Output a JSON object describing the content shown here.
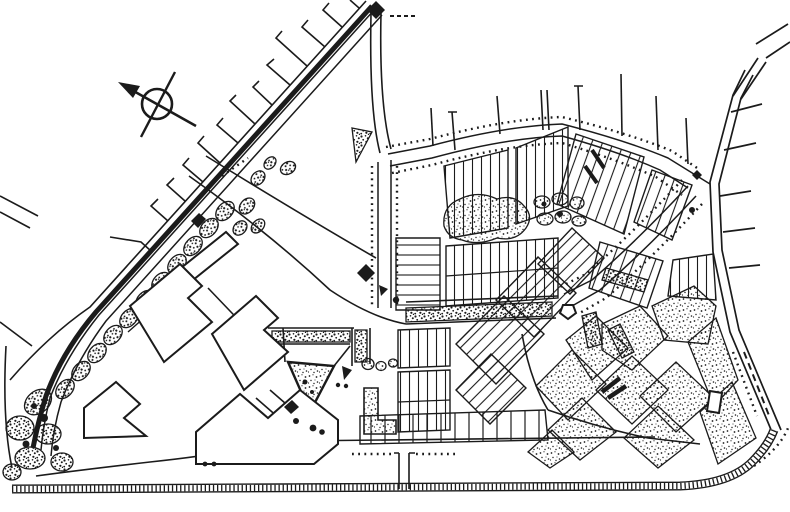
{
  "map": {
    "kind": "scanned urban master plan site drawing",
    "palette": {
      "ink": "#1b1b1b",
      "paper": "#ffffff"
    },
    "north_arrow": {
      "icon": "compass-north-arrow",
      "direction": "points to upper-left (north-west)"
    },
    "features": [
      {
        "id": "north-arrow",
        "label": "compass symbol: circle crossed by two lines, arrowhead to north-west"
      },
      {
        "id": "railway-boulevard",
        "label": "main diagonal boulevard with solid black median band, runs top-centre to lower-left"
      },
      {
        "id": "fishbone-streets",
        "label": "short perpendicular side streets on the north-west side of the boulevard"
      },
      {
        "id": "tree-lined-loop",
        "label": "collector avenue flanked by rows of street-tree dots (north, west and east legs)"
      },
      {
        "id": "bottom-arterial",
        "label": "southern arterial with hatched carriageway band, rounded corner to the east arterial"
      },
      {
        "id": "right-arterial",
        "label": "eastern arterial with stub side streets outside the site"
      },
      {
        "id": "street-network",
        "label": "curvilinear internal streets of the western quarter and service corridor"
      },
      {
        "id": "residential-blocks",
        "label": "subdivision blocks subdivided into narrow individual lots"
      },
      {
        "id": "green-spaces",
        "label": "stippled parks, tree clusters along the boulevard, hedge strips, south-east park wedges"
      },
      {
        "id": "buildings",
        "label": "large white building footprints with heavy outlines; small outlined structures"
      },
      {
        "id": "landmarks",
        "label": "solid black markers: end diamond of boulevard, central diamond landmark, small black buildings"
      }
    ]
  }
}
